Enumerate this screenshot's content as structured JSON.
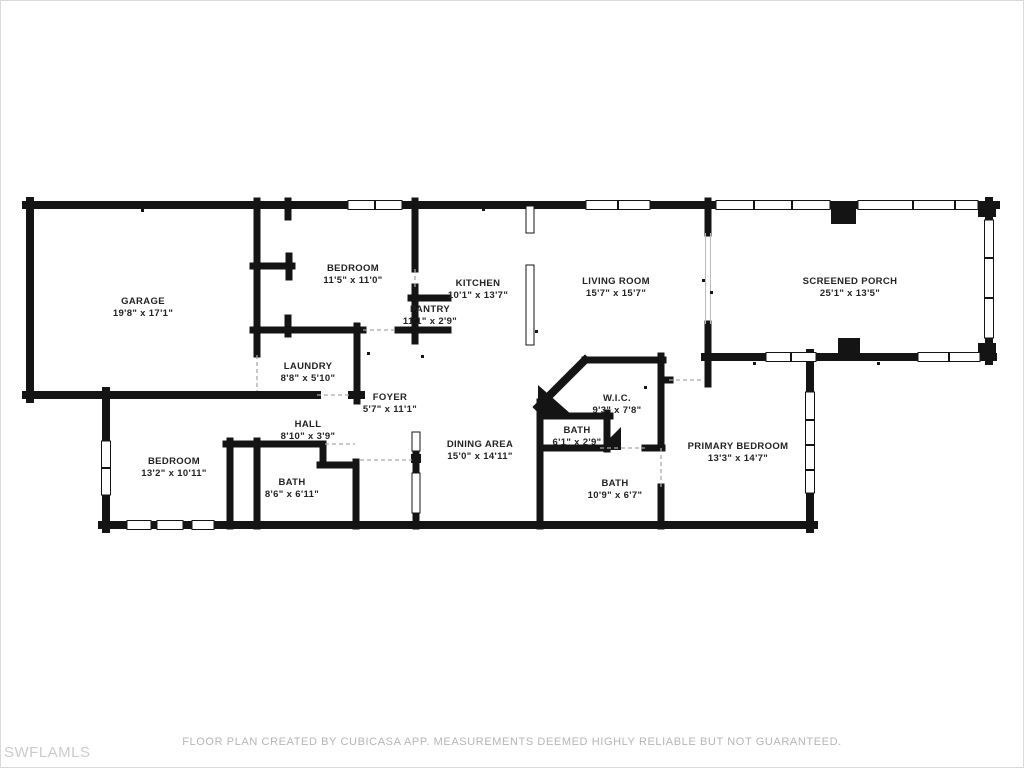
{
  "watermark": "SWFLAMLS",
  "footer": {
    "disclaimer": "FLOOR PLAN CREATED BY CUBICASA APP. MEASUREMENTS DEEMED HIGHLY RELIABLE BUT NOT GUARANTEED."
  },
  "colors": {
    "background": "#ffffff",
    "wall": "#141414",
    "label_text": "#232323",
    "footer_text": "#b5b5b5",
    "watermark_text": "#cbcbcb"
  },
  "rooms": [
    {
      "name": "GARAGE",
      "dims": "19'8\" x 17'1\""
    },
    {
      "name": "BEDROOM",
      "dims": "11'5\" x 11'0\""
    },
    {
      "name": "KITCHEN",
      "dims": "10'1\" x 13'7\""
    },
    {
      "name": "PANTRY",
      "dims": "11'1\" x 2'9\""
    },
    {
      "name": "LIVING ROOM",
      "dims": "15'7\" x 15'7\""
    },
    {
      "name": "SCREENED PORCH",
      "dims": "25'1\" x 13'5\""
    },
    {
      "name": "LAUNDRY",
      "dims": "8'8\" x 5'10\""
    },
    {
      "name": "FOYER",
      "dims": "5'7\" x 11'1\""
    },
    {
      "name": "HALL",
      "dims": "8'10\" x 3'9\""
    },
    {
      "name": "BEDROOM",
      "dims": "13'2\" x 10'11\""
    },
    {
      "name": "BATH",
      "dims": "8'6\" x 6'11\""
    },
    {
      "name": "DINING AREA",
      "dims": "15'0\" x 14'11\""
    },
    {
      "name": "W.I.C.",
      "dims": "9'3\" x 7'8\""
    },
    {
      "name": "BATH",
      "dims": "6'1\" x 2'9\""
    },
    {
      "name": "BATH",
      "dims": "10'9\" x 6'7\""
    },
    {
      "name": "PRIMARY BEDROOM",
      "dims": "13'3\" x 14'7\""
    }
  ]
}
